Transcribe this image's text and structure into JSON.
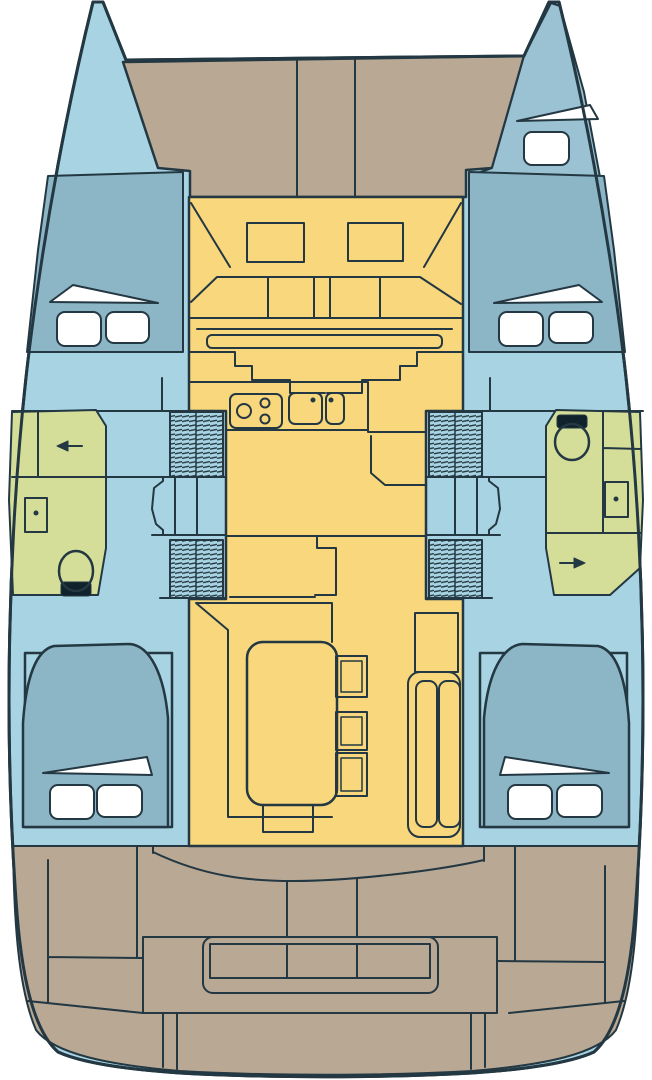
{
  "canvas": {
    "width": 652,
    "height": 1080
  },
  "colors": {
    "background": "#ffffff",
    "hull": "#a8d3e2",
    "cabin": "#8cb5c6",
    "crew_cabin": "#9ac2d2",
    "wet_area": "#d5de98",
    "salon": "#f8d77d",
    "deck": "#b9a894",
    "fixture": "#ffffff",
    "seat": "#10222b",
    "outline": "#233842"
  }
}
